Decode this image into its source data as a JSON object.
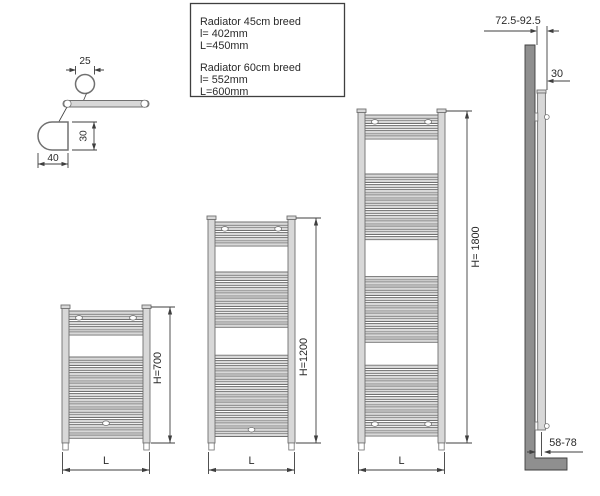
{
  "colors": {
    "line": "#3f3f3f",
    "ink": "#2a2a2a",
    "metal": "#d8d8d8",
    "edge": "#707070",
    "wall": "#8f8f8f",
    "background": "#ffffff"
  },
  "info_box": {
    "lines": [
      "Radiator 45cm breed",
      "l= 402mm",
      "L=450mm",
      "Radiator 60cm breed",
      "l= 552mm",
      "L=600mm"
    ]
  },
  "detail": {
    "labels": {
      "tube_diameter": "25",
      "bracket_height": "30",
      "bracket_depth": "40"
    }
  },
  "radiators": [
    {
      "name": "radiator-h700",
      "height_label": "H=700",
      "length_label": "L",
      "tube_groups": [
        5,
        16
      ],
      "mounts": {
        "top": "pair",
        "bottom": "center"
      }
    },
    {
      "name": "radiator-h1200",
      "height_label": "H=1200",
      "length_label": "L",
      "tube_groups": [
        5,
        11,
        16
      ],
      "mounts": {
        "top": "pair",
        "bottom": "center"
      }
    },
    {
      "name": "radiator-h1800",
      "height_label": "H= 1800",
      "length_label": "L",
      "tube_groups": [
        5,
        13,
        13,
        14
      ],
      "mounts": {
        "top": "pair",
        "bottom": "pair"
      }
    }
  ],
  "side_view": {
    "labels": {
      "top_offset": "72.5-92.5",
      "tube_depth": "30",
      "bottom_offset": "58-78"
    }
  }
}
